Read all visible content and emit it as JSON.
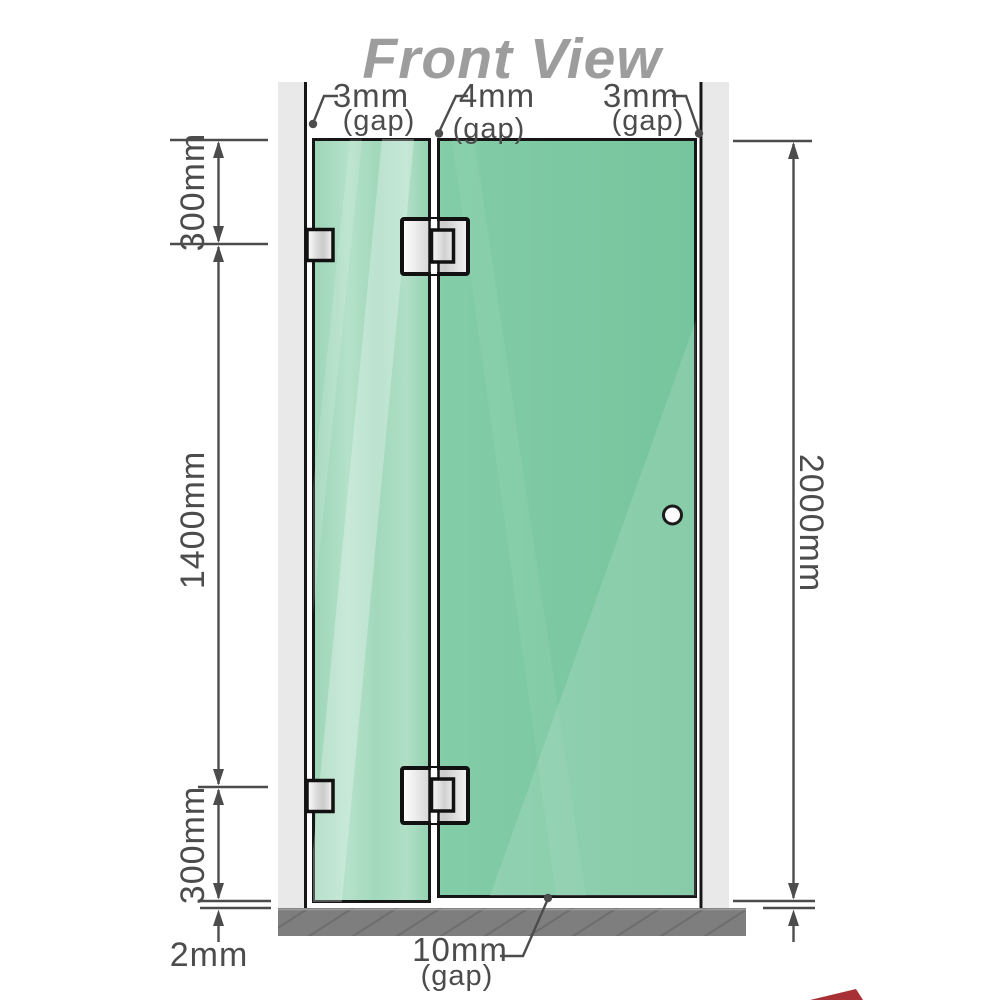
{
  "title": "Front View",
  "annotations": {
    "gap_top_left": {
      "value": "3mm",
      "suffix": "(gap)"
    },
    "gap_top_middle": {
      "value": "4mm",
      "suffix": "(gap)"
    },
    "gap_top_right": {
      "value": "3mm",
      "suffix": "(gap)"
    },
    "gap_bottom": {
      "value": "10mm",
      "suffix": "(gap)"
    },
    "dim_left_top": "300mm",
    "dim_left_middle": "1400mm",
    "dim_left_bottom": "300mm",
    "dim_left_floor": "2mm",
    "dim_right_height": "2000mm"
  },
  "colors": {
    "glass_door": "#7cc8a2",
    "glass_fixed_light": "#a6d9bf",
    "wall": "#e9e9e9",
    "floor": "#7e7e7e",
    "outline": "#161616",
    "dimension": "#4c4c4c",
    "title": "#9d9d9d",
    "accent_red": "#9e1b20"
  }
}
